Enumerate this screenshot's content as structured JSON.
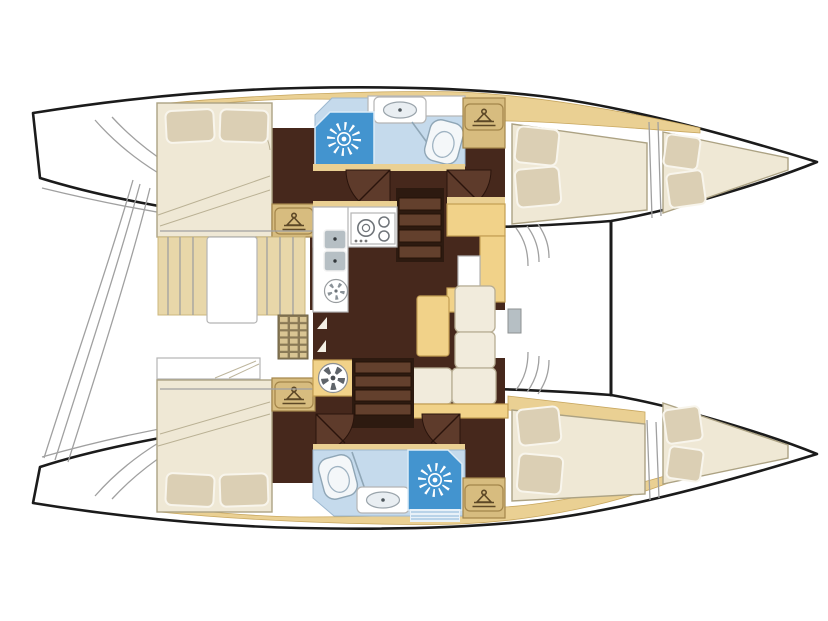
{
  "meta": {
    "type": "boat-floor-plan",
    "vessel": "sailing catamaran (two hulls + central salon)",
    "orientation": {
      "bow": "right",
      "stern": "left"
    },
    "visible_text": []
  },
  "palette": {
    "outline": "#1b1b1b",
    "thin-line": "#a0a0a0",
    "deck": "#ead093",
    "deck-edge": "#c8a75f",
    "floor": "#46281c",
    "door": "#5e3b2b",
    "door-line": "#2a140c",
    "bed": "#efe8d5",
    "bed-edge": "#aca283",
    "pillow": "#dbcfb4",
    "pillow-edge": "#f8f5ec",
    "bath": "#c5daec",
    "shower": "#4394cf",
    "counter-edge": "#b5b5b5",
    "furniture": "#f1d289",
    "furniture-edge": "#c39e53",
    "cushion": "#f1ebdc",
    "cushion-edge": "#b7ad93",
    "steel": "#b6bfc4",
    "stairs-bg": "#2d1a10",
    "stair-step": "#63402d",
    "badge": "#d7bc7f",
    "badge-edge": "#a3854a",
    "badge-glyph": "#5d4827",
    "curtain": "#e8d7a9",
    "lattice-bg": "#8a7a56",
    "lattice-cell": "#d9c593",
    "stripe": "#a9c9e2"
  },
  "rooms": {
    "port_hull_top": {
      "aft_cabin": {
        "berth": "double",
        "pillows": 2,
        "wardrobe_icons": 1
      },
      "head": {
        "shower_sun_icon": 1,
        "toilet": 1,
        "washbasin": 1
      },
      "forward_cabin": {
        "berth": "double",
        "pillows": 2
      },
      "forepeak_berth": {
        "pillows": 2
      }
    },
    "starboard_hull_bottom": {
      "aft_cabin": {
        "berth": "double",
        "pillows": 2,
        "wardrobe_icons": 1
      },
      "head": {
        "shower_sun_icon": 1,
        "toilet": 1,
        "washbasin": 1
      },
      "forward_cabin": {
        "berth": "double",
        "pillows": 2
      },
      "forepeak_berth": {
        "pillows": 2
      }
    },
    "salon": {
      "galley": {
        "sinks": 2,
        "round_sink": 1,
        "stove_burners": 3
      },
      "chart_table": 1,
      "sofa_cushions": 4,
      "coffee_table": 1,
      "companionway_stairs": 2,
      "wardrobe_icons_hull_side": 2,
      "vent_fan_icon": 1,
      "louvered_locker": 1
    },
    "cockpit_aft": {
      "transom_steps": true
    },
    "foredeck": {
      "window_mullions": true,
      "mast_step": 1
    }
  },
  "icons": [
    {
      "name": "shower-sun-icon",
      "count": 2
    },
    {
      "name": "wardrobe-hanger-icon",
      "count": 4
    },
    {
      "name": "toilet-icon",
      "count": 2
    },
    {
      "name": "washbasin-icon",
      "count": 2
    },
    {
      "name": "galley-sink-icon",
      "count": 2
    },
    {
      "name": "stove-burner-icon",
      "count": 3
    },
    {
      "name": "vent-fan-icon",
      "count": 1
    },
    {
      "name": "round-sink-icon",
      "count": 1
    },
    {
      "name": "step-arrow-icon",
      "count": 2
    }
  ]
}
